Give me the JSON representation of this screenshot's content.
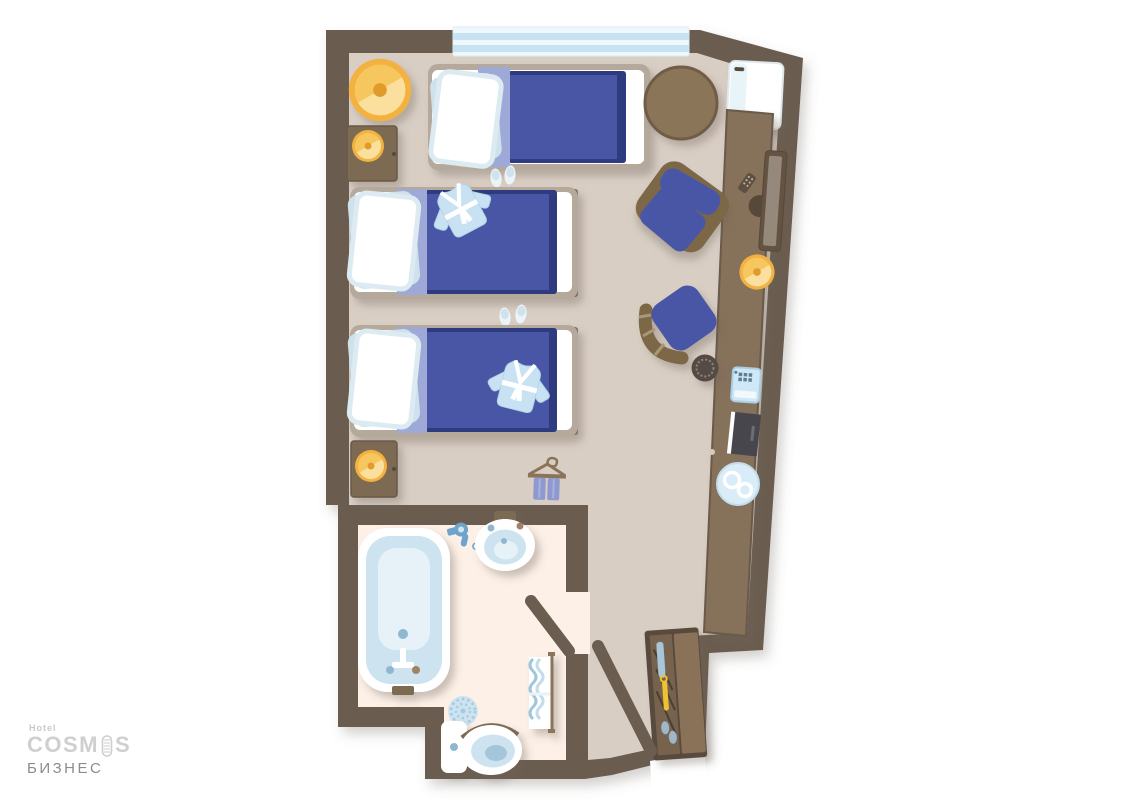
{
  "brand": {
    "hotel_label": "Hotel",
    "name_full": "COSMOS",
    "name_prefix": "COSM",
    "name_suffix": "S",
    "room_type": "БИЗНЕС"
  },
  "floor_plan": {
    "furniture": [
      "window",
      "round-pouf",
      "nightstand-with-lamp",
      "single-bed",
      "single-bed",
      "single-bed",
      "bathrobe",
      "slippers",
      "clothes-hanger-with-trousers",
      "round-table",
      "mini-fridge",
      "media-console",
      "tv",
      "remote-control",
      "desk-lamp",
      "armchair",
      "desk-chair",
      "wastebasket",
      "telephone",
      "menu-book",
      "tea-tray",
      "wardrobe",
      "entry-door",
      "bathroom-door",
      "bathtub",
      "hair-dryer",
      "washbasin",
      "bath-mat",
      "toilet",
      "towel-rack"
    ],
    "colors": {
      "wall": "#6b5d4f",
      "floor": "#d9cec4",
      "bathroom_floor": "#fcf0e7",
      "wood": "#86715a",
      "bed_blue": "#4a57a6",
      "bed_navy": "#2e3a7e",
      "fold_band": "#9fa9d8",
      "linen_blue": "#cde4f0",
      "window_blue": "#c7e3f1",
      "accent_yellow": "#f5bd4a"
    }
  }
}
